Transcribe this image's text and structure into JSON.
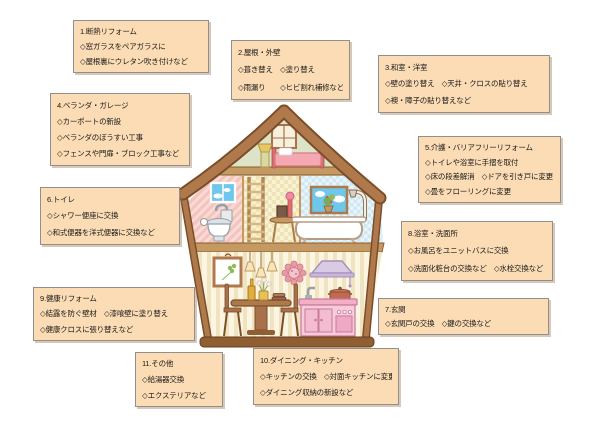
{
  "boxes": [
    {
      "title": "1.断熱リフォーム",
      "lines": [
        "◇窓ガラスをペアガラスに",
        "◇屋根裏にウレタン吹き付けなど"
      ]
    },
    {
      "title": "2.屋根・外壁",
      "lines": [
        "◇葺き替え　◇塗り替え",
        "◇雨漏り　　◇ヒビ割れ補修など"
      ]
    },
    {
      "title": "3.和室・洋室",
      "lines": [
        "◇壁の塗り替え　◇天井・クロスの貼り替え",
        "◇襖・障子の貼り替えなど"
      ]
    },
    {
      "title": "4.ベランダ・ガレージ",
      "lines": [
        "◇カーポートの新設",
        "◇ベランダのぼうすい工事",
        "◇フェンスや門扉・ブロック工事など"
      ]
    },
    {
      "title": "5.介護・バリアフリーリフォーム",
      "lines": [
        "◇トイレや浴室に手摺を取付",
        "◇床の段差解消　◇ドアを引き戸に変更",
        "◇畳をフローリングに変更"
      ]
    },
    {
      "title": "6.トイレ",
      "lines": [
        "◇シャワー便座に交換",
        "◇和式便器を洋式便器に交換など"
      ]
    },
    {
      "title": "7.玄関",
      "lines": [
        "◇玄関戸の交換　◇鍵の交換など"
      ]
    },
    {
      "title": "8.浴室・洗面所",
      "lines": [
        "◇お風呂をユニットバスに交換",
        "◇洗面化粧台の交換など　◇水栓交換など"
      ]
    },
    {
      "title": "9.健康リフォーム",
      "lines": [
        "◇結露を防ぐ壁材　◇漆喰壁に塗り替え",
        "◇健康クロスに張り替えなど"
      ]
    },
    {
      "title": "10.ダイニング・キッチン",
      "lines": [
        "◇キッチンの交換　◇対面キッチンに変更",
        "◇ダイニング収納の新設など"
      ]
    },
    {
      "title": "11.その他",
      "lines": [
        "◇給湯器交換",
        "◇エクステリアなど"
      ]
    }
  ],
  "colors": {
    "box_fill": "#FBDCB4",
    "box_border": "#8F8F8F",
    "text": "#1A1A1A",
    "roof_brown": "#B0794C",
    "roof_outline": "#7A4E28",
    "attic_green": "#DDE3C6",
    "room_pink": "#F9DAD5",
    "room_cream": "#F8F1D4",
    "room_blue": "#EAF5FA",
    "kitchen_pink": "#F7CBDA",
    "hood_lavender": "#D9CBE4",
    "sky_blue": "#6FC8EC"
  }
}
